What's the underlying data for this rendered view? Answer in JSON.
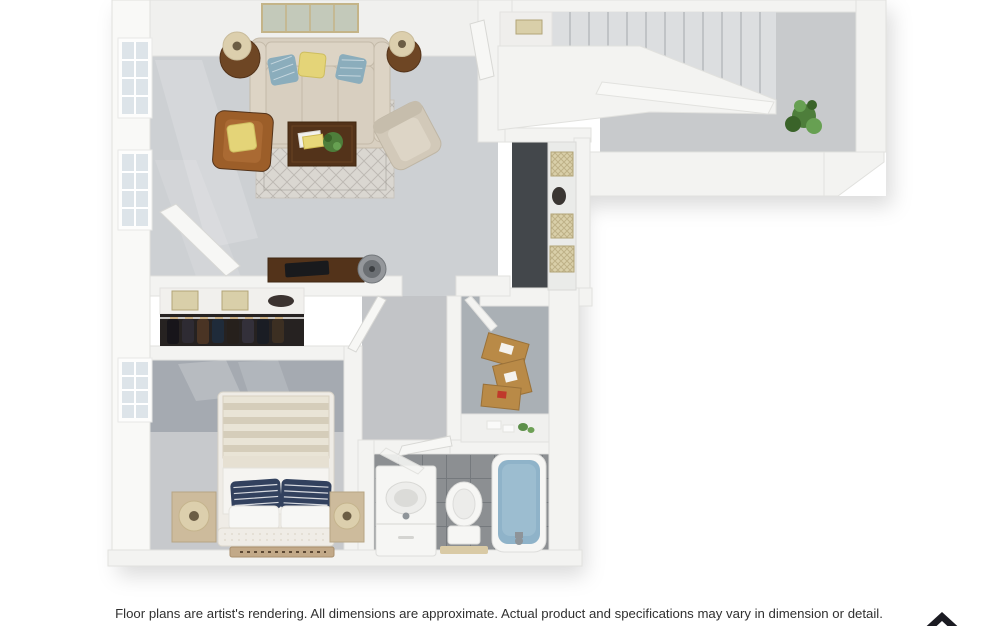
{
  "page": {
    "width": 998,
    "height": 626,
    "background": "#ffffff"
  },
  "disclaimer": {
    "text": "Floor plans are artist's rendering. All dimensions are approximate. Actual product and specifications may vary in dimension or detail."
  },
  "logo": {
    "shape": "upward-chevron-mark"
  },
  "scene": {
    "type": "3d-floor-plan-render",
    "view": "top-down",
    "rooms": [
      "living-room",
      "staircase",
      "entry-hall",
      "kitchen-pantry-nook",
      "coat-closet",
      "hallway",
      "walk-in-closet",
      "bedroom",
      "bathroom"
    ],
    "furniture": [
      "sofa",
      "throw-pillows",
      "end-tables",
      "table-lamps",
      "leather-armchair",
      "accent-chair",
      "coffee-table",
      "magazines",
      "table-plant",
      "area-rug",
      "wall-art",
      "windows",
      "open-front-door",
      "stairs",
      "under-stair-shelf",
      "stair-railing",
      "entry-plant",
      "pantry-counter",
      "pantry-baskets",
      "desk",
      "laptop",
      "desk-fan",
      "closet-shelf-boxes",
      "hanging-clothes",
      "moving-boxes",
      "closet-counter",
      "bed",
      "striped-duvet",
      "navy-striped-pillows",
      "nightstands",
      "drum-lamps",
      "bedside-runner-rug",
      "vanity-sink",
      "toilet",
      "bath-mat",
      "bathtub",
      "shower-door"
    ]
  },
  "palette": {
    "pagebg": "#ffffff",
    "wall": "#f3f3f1",
    "wallhi": "#f9f9f7",
    "topband": "#f0f0ee",
    "walledge": "#e1e1de",
    "doorleaf": "#f7f7f5",
    "dooredge": "#d8d8d5",
    "glass": "#dde4e9",
    "carpet": "#cdd0d3",
    "graywall": "#a5aab1",
    "bedcarpet": "#c7c9cc",
    "entryfloor": "#c8cacc",
    "hallfloor": "#c2c4c7",
    "closetfloor": "#aab0b5",
    "kdark": "#43474b",
    "counter": "#eaebe9",
    "stair": "#dcdee0",
    "stairedge": "#c0c3c6",
    "tile": "#8c8f92",
    "tilegrout": "#75797d",
    "sofa": "#d8cfc0",
    "sofatrim": "#c4baa9",
    "cushion": "#ddd4c5",
    "pillowblue": "#8badbc",
    "pillowyellow": "#e4d478",
    "pillownavy": "#32415e",
    "leather": "#9c5e29",
    "leatherinner": "#aa6a33",
    "accent": "#d2c9b9",
    "accentinner": "#ddd5c6",
    "wood": "#6e4624",
    "wooddark": "#53331a",
    "rugbase": "#dad7d1",
    "rugline": "#85817a",
    "bed": "#efece6",
    "duveta": "#e9e4d6",
    "duvetb": "#d5cdba",
    "linen": "#f5f4f1",
    "nightstand": "#cdbb9c",
    "lampshade": "#dccfad",
    "lampcore": "#6b5d45",
    "runner": "#c2a988",
    "runnermark": "#5c4833",
    "plant": "#4e7e3b",
    "plantdark": "#3a6329",
    "plantlight": "#67a052",
    "cardboard": "#b98a47",
    "cardboardedge": "#9a7138",
    "basket": "#d9cfa9",
    "basketline": "#b2a478",
    "clothesbg": "#262221",
    "water": "#8fb3c9",
    "waterlight": "#a9c8d8",
    "porcelain": "#f6f6f4",
    "porcelainedge": "#dddddb",
    "mat": "#d9caa5",
    "metal": "#8e9499",
    "art": "#c3c9ba",
    "artframe": "#c4b488",
    "text": "#303030",
    "logocolor": "#1b1b22"
  }
}
